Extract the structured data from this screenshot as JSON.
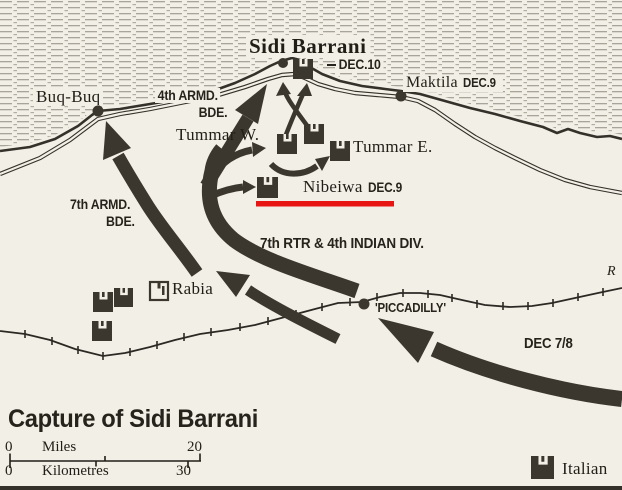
{
  "map": {
    "title": "Capture of Sidi Barrani",
    "places": {
      "sidi_barrani": "Sidi Barrani",
      "sidi_barrani_date": "DEC.10",
      "maktila": "Maktila",
      "maktila_date": "DEC.9",
      "buq_buq": "Buq-Buq",
      "tummar_w": "Tummar W.",
      "tummar_e": "Tummar E.",
      "nibeiwa": "Nibeiwa",
      "nibeiwa_date": "DEC.9",
      "rabia": "Rabia",
      "piccadilly": "'PICCADILLY'",
      "railway_edge_label": "R"
    },
    "units": {
      "armd4_line1": "4th ARMD.",
      "armd4_line2": "BDE.",
      "armd7_line1": "7th ARMD.",
      "armd7_line2": "BDE.",
      "rtr_indian": "7th RTR & 4th INDIAN DIV.",
      "dec78": "DEC 7/8"
    },
    "scale": {
      "miles_zero": "0",
      "miles_label": "Miles",
      "miles_max": "20",
      "km_zero": "0",
      "km_label": "Kilometres",
      "km_max": "30"
    },
    "legend": {
      "italian_label": "Italian"
    },
    "colors": {
      "paper": "#f2efe6",
      "ink": "#3c372e",
      "sea_hatch": "#a9a49a",
      "red_underline": "#e81515"
    }
  }
}
